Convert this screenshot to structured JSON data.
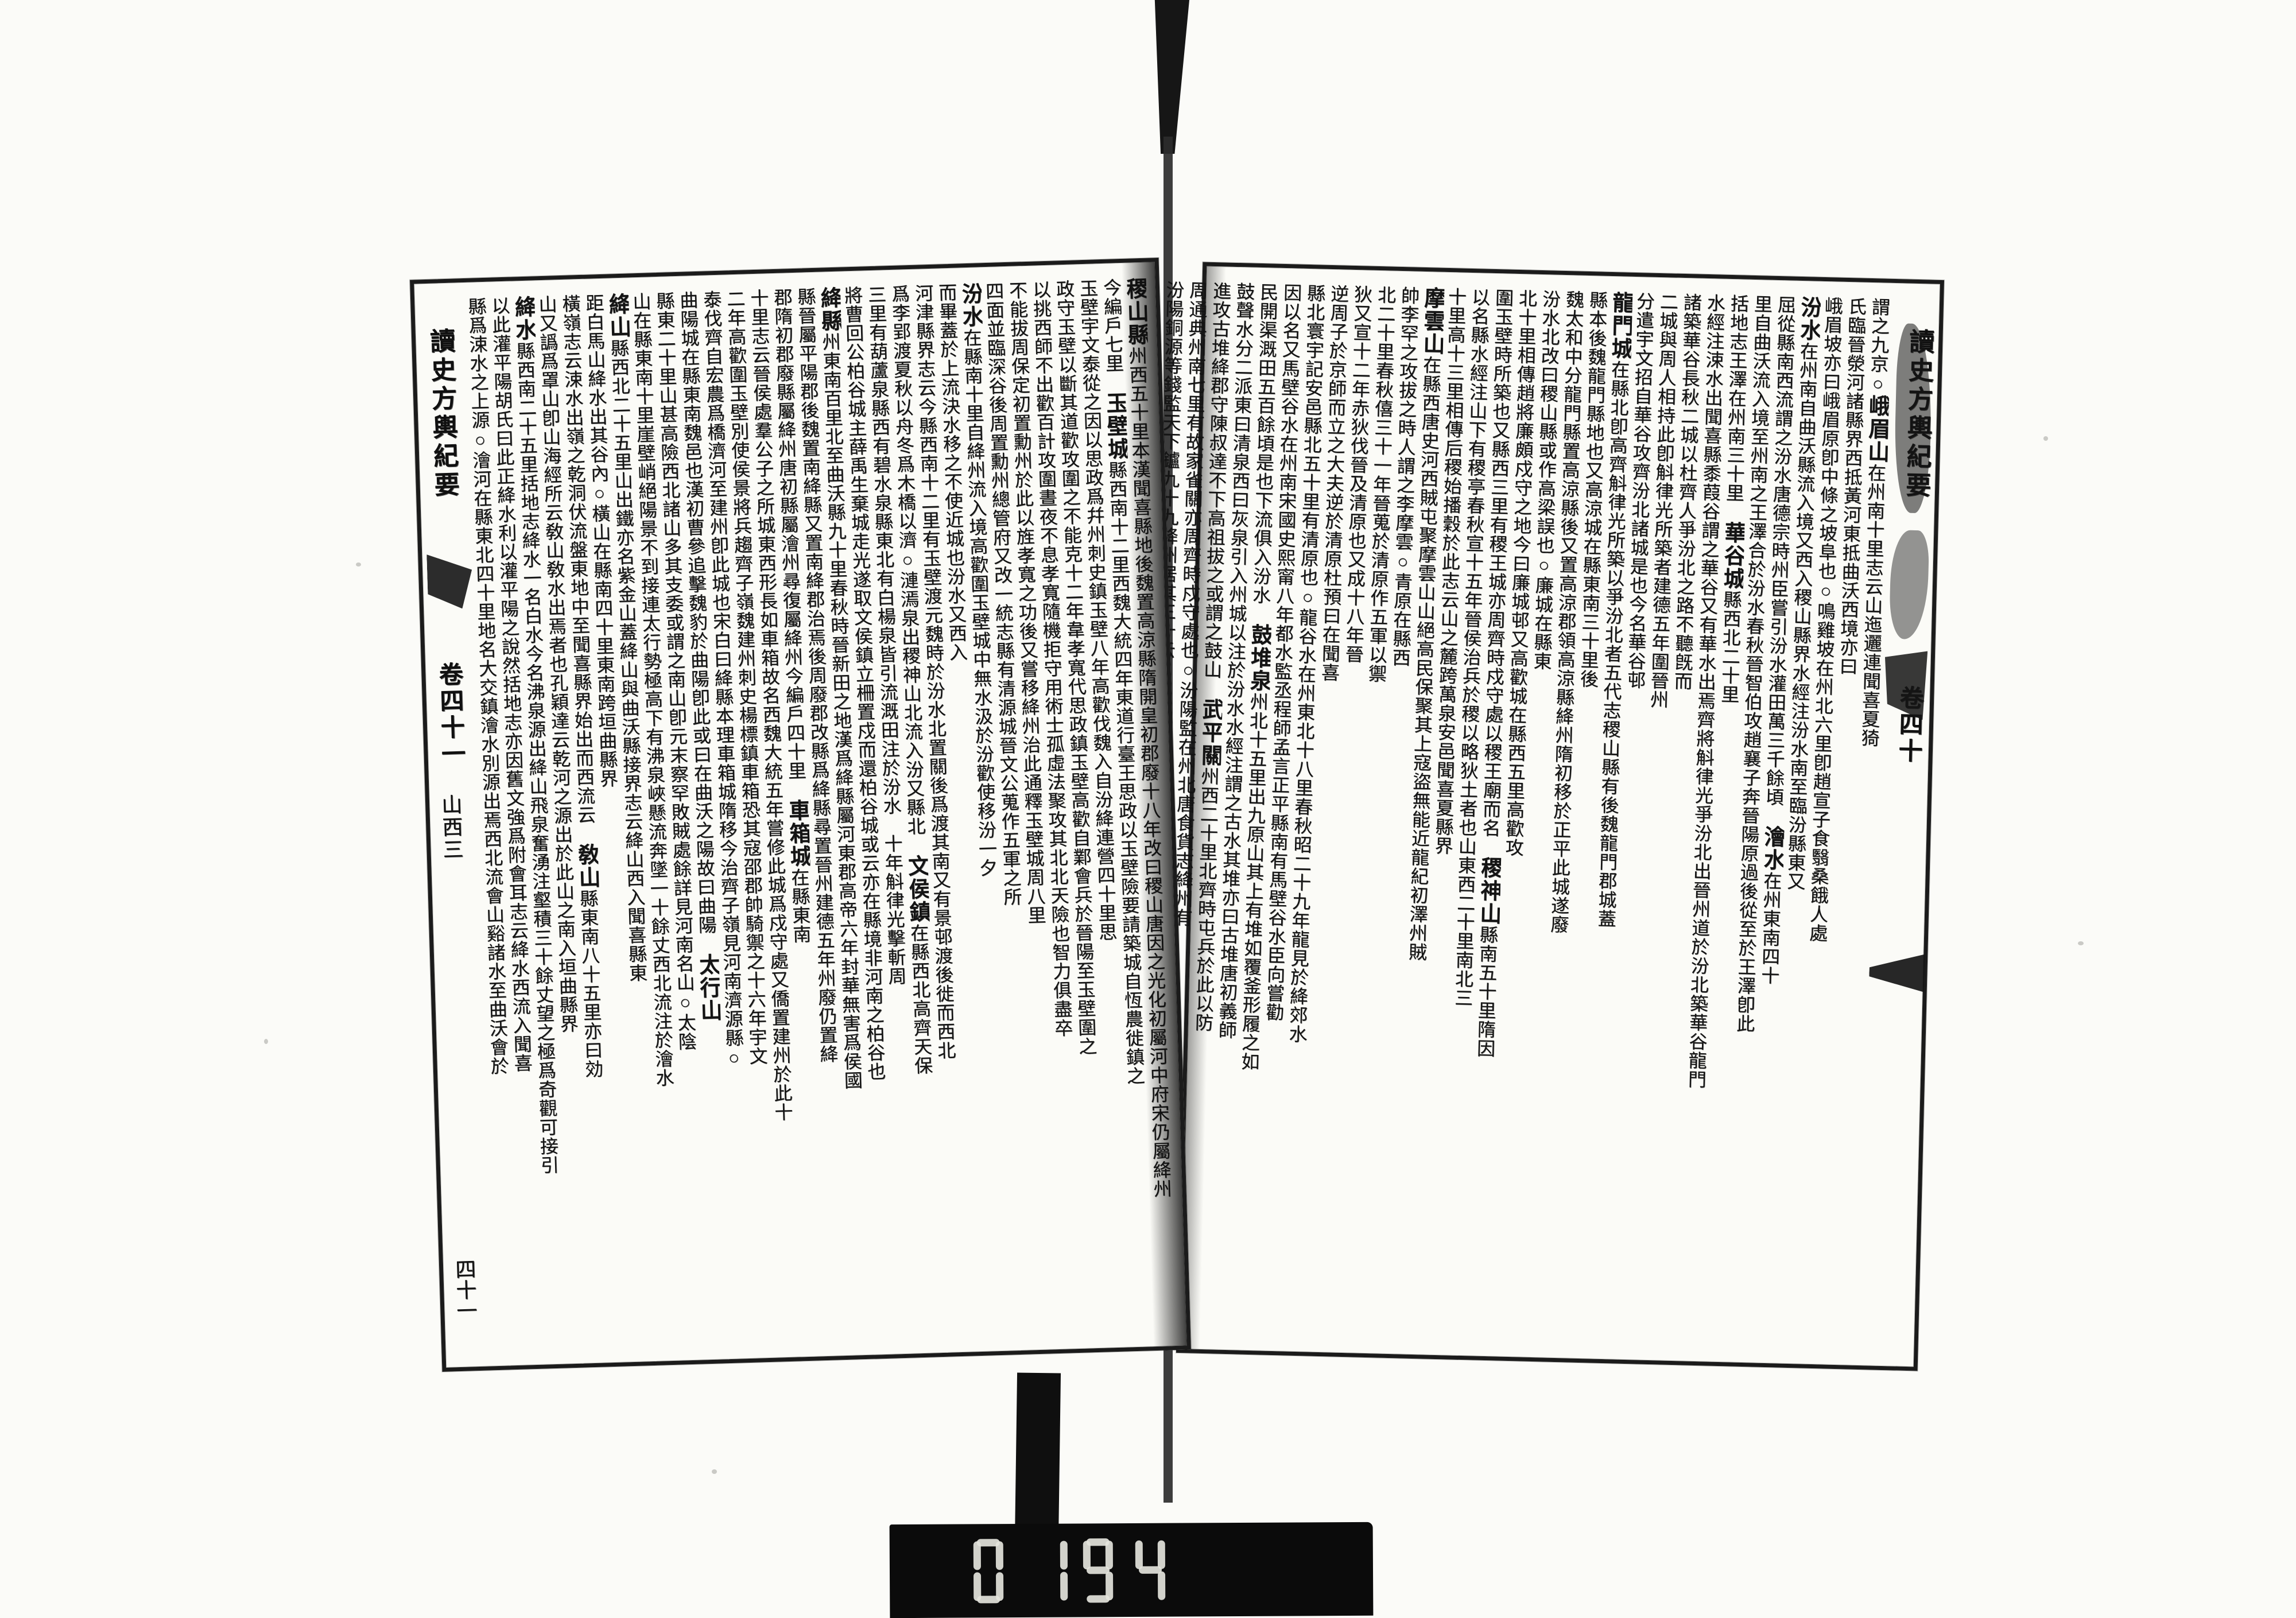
{
  "film": {
    "counter": {
      "digits": "0194"
    }
  },
  "right_page": {
    "banxin": {
      "title": "讀史方輿紀要",
      "volume": "卷四十"
    },
    "columns": [
      [
        [
          "謂之九京○",
          0
        ],
        [
          "峨眉山",
          1
        ],
        [
          "在州南十里志云山迤邐連聞喜夏猗",
          0
        ]
      ],
      [
        [
          "氏臨晉滎河諸縣界西抵黃河東抵曲沃西境亦曰",
          0
        ]
      ],
      [
        [
          "峨眉坡亦曰峨眉原卽中條之坡阜也○鳴雞坡在州北六里卽趙宣子食翳桑餓人處",
          0
        ]
      ],
      [
        [
          "汾水",
          1
        ],
        [
          "在州南自曲沃縣流入境又西入稷山縣界水經注汾水南至臨汾縣東又",
          0
        ]
      ],
      [
        [
          "屈從縣南西流謂之汾水唐德宗時州臣嘗引汾水灌田萬三千餘頃　",
          0
        ],
        [
          "澮水",
          1
        ],
        [
          "在州東南四十",
          0
        ]
      ],
      [
        [
          "里自曲沃流入境至州南之王澤合於汾水春秋晉智伯攻趙襄子奔晉陽原過後從至於王澤卽此",
          0
        ]
      ],
      [
        [
          "括地志王澤在州南三十里　",
          0
        ],
        [
          "華谷城",
          1
        ],
        [
          "縣西北二十里",
          0
        ]
      ],
      [
        [
          "水經注涑水出聞喜縣黍葭谷謂之華谷又有華水出焉齊將斛律光爭汾北出晉州道於汾北築華谷龍門",
          0
        ]
      ],
      [
        [
          "諸築華谷長秋二城以杜齊人爭汾北之路不聽旣而",
          0
        ]
      ],
      [
        [
          "二城與周人相持此卽斛律光所築者建德五年圍晉州",
          0
        ]
      ],
      [
        [
          "分遣宇文招自華谷攻齊汾北諸城是也今名華谷邨",
          0
        ]
      ],
      [
        [
          "龍門城",
          1
        ],
        [
          "在縣北卽高齊斛律光所築以爭汾北者五代志稷山縣有後魏龍門郡城蓋",
          0
        ]
      ],
      [
        [
          "縣本後魏龍門縣地也又高涼城在縣東南三十里後",
          0
        ]
      ],
      [
        [
          "魏太和中分龍門縣置高涼縣後又置高涼郡領高涼縣絳州隋初移於正平此城遂廢",
          0
        ]
      ],
      [
        [
          "汾水北改曰稷山縣或作高梁誤也○廉城在縣東",
          0
        ]
      ],
      [
        [
          "北十里相傳趙將廉頗戍守之地今曰廉城邨又高歡城在縣西五里高歡攻",
          0
        ]
      ],
      [
        [
          "圍玉壁時所築也又縣西三里有稷王城亦周齊時戍守處以稷王廟而名　",
          0
        ],
        [
          "稷神山",
          1
        ],
        [
          "縣南五十里隋因",
          0
        ]
      ],
      [
        [
          "以名縣水經注山下有稷亭春秋宣十五年晉侯治兵於稷以略狄土者也山東西二十里南北三",
          0
        ]
      ],
      [
        [
          "十里高十三里相傳后稷始播穀於此志云山之麓跨萬泉安邑聞喜夏縣界",
          0
        ]
      ],
      [
        [
          "摩雲山",
          1
        ],
        [
          "在縣西唐史河西賊屯聚摩雲山山絕高民保聚其上寇盜無能近龍紀初澤州賊",
          0
        ]
      ],
      [
        [
          "帥李罕之攻拔之時人謂之李摩雲○青原在縣西",
          0
        ]
      ],
      [
        [
          "北二十里春秋僖三十一年晉蒐於清原作五軍以禦",
          0
        ]
      ],
      [
        [
          "狄又宣十二年赤狄伐晉及清原也又成十八年晉",
          0
        ]
      ],
      [
        [
          "逆周子於京師而立之大夫逆於清原杜預曰在聞喜",
          0
        ]
      ],
      [
        [
          "縣北寰宇記安邑縣北五十里有清原也○龍谷水在州東北十八里春秋昭二十九年龍見於絳郊水",
          0
        ]
      ],
      [
        [
          "因以名又馬壁谷水在州南宋國史熙甯八年都水監丞程師孟言正平縣南有馬壁谷水臣向嘗勸",
          0
        ]
      ],
      [
        [
          "民開渠溉田五百餘頃是也下流俱入汾水　",
          0
        ],
        [
          "鼓堆泉",
          1
        ],
        [
          "州北十五里出九原山其上有堆如覆釜形履之如",
          0
        ]
      ],
      [
        [
          "鼓聲水分二派東曰清泉西曰灰泉引入州城以注於汾水水經注謂之古水其堆亦曰古堆唐初義師",
          0
        ]
      ],
      [
        [
          "進攻古堆絳郡守陳叔達不下高祖拔之或謂之鼓山　",
          0
        ],
        [
          "武平關",
          1
        ],
        [
          "州西二十里北齊時屯兵於此以防",
          0
        ]
      ],
      [
        [
          "周通典州南七里有故家雀關亦周齊時戍守處也○汾陽監在州北唐食貨志絳州有",
          0
        ]
      ],
      [
        [
          "汾陽銅源等錢監天下鑪九十九絳州居其三十云",
          0
        ]
      ]
    ]
  },
  "left_page": {
    "banxin": {
      "title": "讀史方輿紀要",
      "volume": "卷四十一",
      "section": "山西三",
      "leaf_number": "四十一"
    },
    "columns": [
      [
        [
          "稷山縣",
          1
        ],
        [
          "州西五十里本漢聞喜縣地後魏置高涼縣隋開皇初郡廢十八年改曰稷山唐因之光化初屬河中府宋仍屬絳州",
          0
        ]
      ],
      [
        [
          "今編戶七里　",
          0
        ],
        [
          "玉壁城",
          1
        ],
        [
          "縣西南十二里西魏大統四年東道行臺王思政以玉壁險要請築城自恆農徙鎮之",
          0
        ]
      ],
      [
        [
          "玉壁宇文泰從之因以思政爲幷州刺史鎮玉壁八年高歡伐魏入自汾絳連營四十里思",
          0
        ]
      ],
      [
        [
          "政守玉壁以斷其道歡攻圍之不能克十二年韋孝寬代思政鎮玉壁高歡自鄴會兵於晉陽至玉壁圍之",
          0
        ]
      ],
      [
        [
          "以挑西師不出歡百計攻圍晝夜不息孝寬隨機拒守用術士孤虛法聚攻其北北天險也智力俱盡卒",
          0
        ]
      ],
      [
        [
          "不能拔周保定初置勳州於此以旌孝寬之功後又嘗移絳州治此通釋玉壁城周八里",
          0
        ]
      ],
      [
        [
          "四面並臨深谷後周置勳州總管府又改一統志縣有清源城晉文公蒐作五軍之所",
          0
        ]
      ],
      [
        [
          "汾水",
          1
        ],
        [
          "在縣南十里自絳州流入境高歡圍玉壁城中無水汲於汾歡使移汾一夕",
          0
        ]
      ],
      [
        [
          "而畢蓋於上流決水移之不使近城也汾水又西入",
          0
        ]
      ],
      [
        [
          "河津縣界志云今縣西南十二里有玉壁渡元魏時於汾水北置關後爲渡其南又有景邨渡後徙而西北",
          0
        ]
      ],
      [
        [
          "爲李郢渡夏秋以舟冬爲木橋以濟○漣漹泉出稷神山北流入汾又縣北　",
          0
        ],
        [
          "文侯鎮",
          1
        ],
        [
          "在縣西北高齊天保",
          0
        ]
      ],
      [
        [
          "三里有葫蘆泉縣西有碧水泉縣東北有白楊泉皆引流溉田注於汾水　十年斛律光擊斬周",
          0
        ]
      ],
      [
        [
          "將曹回公柏谷城主薛禹生棄城走光遂取文侯鎮立柵置戍而還柏谷城或云亦在縣境非河南之柏谷也",
          0
        ]
      ],
      [
        [
          "絳縣",
          1
        ],
        [
          "州東南百里北至曲沃縣九十里春秋時晉新田之地漢爲絳縣屬河東郡高帝六年封華無害爲侯國",
          0
        ]
      ],
      [
        [
          "縣晉屬平陽郡後魏置南絳縣又置南絳郡治焉後周廢郡改縣爲絳縣尋置晉州建德五年州廢仍置絳",
          0
        ]
      ],
      [
        [
          "郡隋初郡廢縣屬絳州唐初縣屬澮州尋復屬絳州今編戶四十里　",
          0
        ],
        [
          "車箱城",
          1
        ],
        [
          "在縣東南",
          0
        ]
      ],
      [
        [
          "十里志云晉侯處羣公子之所城東西形長如車箱故名西魏大統五年嘗修此城爲戍守處又僑置建州於此十",
          0
        ]
      ],
      [
        [
          "二年高歡圍玉壁別使侯景將兵趨齊子嶺魏建州刺史楊標鎮車箱恐其寇邵郡帥騎禦之十六年宇文",
          0
        ]
      ],
      [
        [
          "泰伐齊自宏農爲橋濟河至建州卽此城也宋白曰絳縣本理車箱城隋移今治齊子嶺見河南濟源縣○",
          0
        ]
      ],
      [
        [
          "曲陽城在縣東南魏邑也漢初曹參追擊魏豹於曲陽卽此或曰在曲沃之陽故曰曲陽　",
          0
        ],
        [
          "太行山",
          1
        ]
      ],
      [
        [
          "縣東二十里山甚高險西北諸山多其支委或謂之南山卽元末察罕敗賊處餘詳見河南名山○太陰",
          0
        ]
      ],
      [
        [
          "山在縣東南十里崖壁峭絕陽景不到接連太行勢極高下有沸泉峽懸流奔墜一十餘丈西北流注於澮水",
          0
        ]
      ],
      [
        [
          "絳山",
          1
        ],
        [
          "縣西北二十五里山出鐵亦名紫金山蓋絳山與曲沃縣接界志云絳山西入聞喜縣東",
          0
        ]
      ],
      [
        [
          "距白馬山絳水出其谷內○橫山在縣南四十里東南跨垣曲縣界",
          0
        ]
      ],
      [
        [
          "橫嶺志云涑水出嶺之乾洞伏流盤東地中至聞喜縣界始出而西流云　",
          0
        ],
        [
          "敎山",
          1
        ],
        [
          "縣東南八十五里亦曰効",
          0
        ]
      ],
      [
        [
          "山又譌爲罩山卽山海經所云敎山敎水出焉者也孔穎達云乾河之源出於此山之南入垣曲縣界",
          0
        ]
      ],
      [
        [
          "絳水",
          1
        ],
        [
          "縣西南二十五里括地志絳水一名白水今名沸泉源出絳山飛泉奮湧注壑積三十餘丈望之極爲奇觀可接引",
          0
        ]
      ],
      [
        [
          "以此灌平陽胡氏曰此正絳水利以灌平陽之說然括地志亦因舊文強爲附會耳志云絳水西流入聞喜",
          0
        ]
      ],
      [
        [
          "縣爲涑水之上源○澮河在縣東北四十里地名大交鎮澮水別源出焉西北流會山谿諸水至曲沃會於",
          0
        ]
      ]
    ]
  }
}
